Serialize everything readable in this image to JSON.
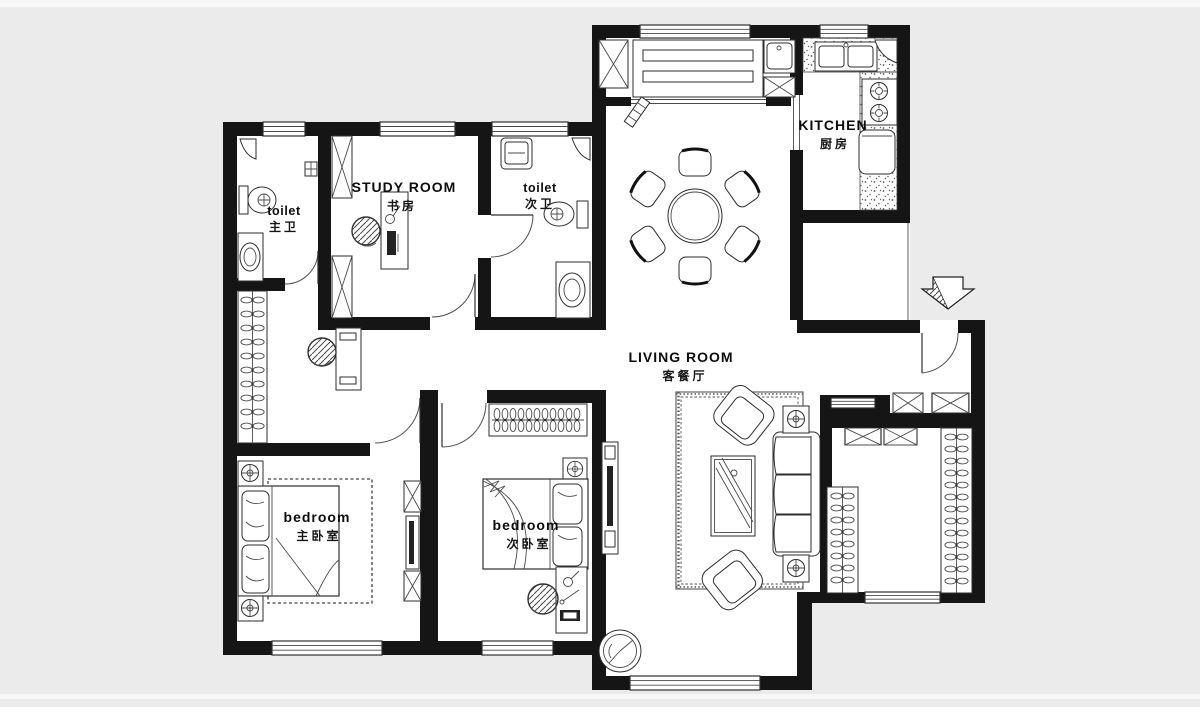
{
  "colors": {
    "page_bg": "#ebebeb",
    "plan_bg": "#ffffff",
    "wall": "#151515",
    "line": "#2e2e2e"
  },
  "rooms": {
    "toilet_master": {
      "label": "toilet",
      "label_cn": "主卫"
    },
    "study": {
      "label": "STUDY ROOM",
      "label_cn": "书房"
    },
    "toilet_second": {
      "label": "toilet",
      "label_cn": "次卫"
    },
    "kitchen": {
      "label": "KITCHEN",
      "label_cn": "厨房"
    },
    "living": {
      "label": "LIVING ROOM",
      "label_cn": "客餐厅"
    },
    "bedroom_master": {
      "label": "bedroom",
      "label_cn": "主卧室"
    },
    "bedroom_second": {
      "label": "bedroom",
      "label_cn": "次卧室"
    }
  }
}
